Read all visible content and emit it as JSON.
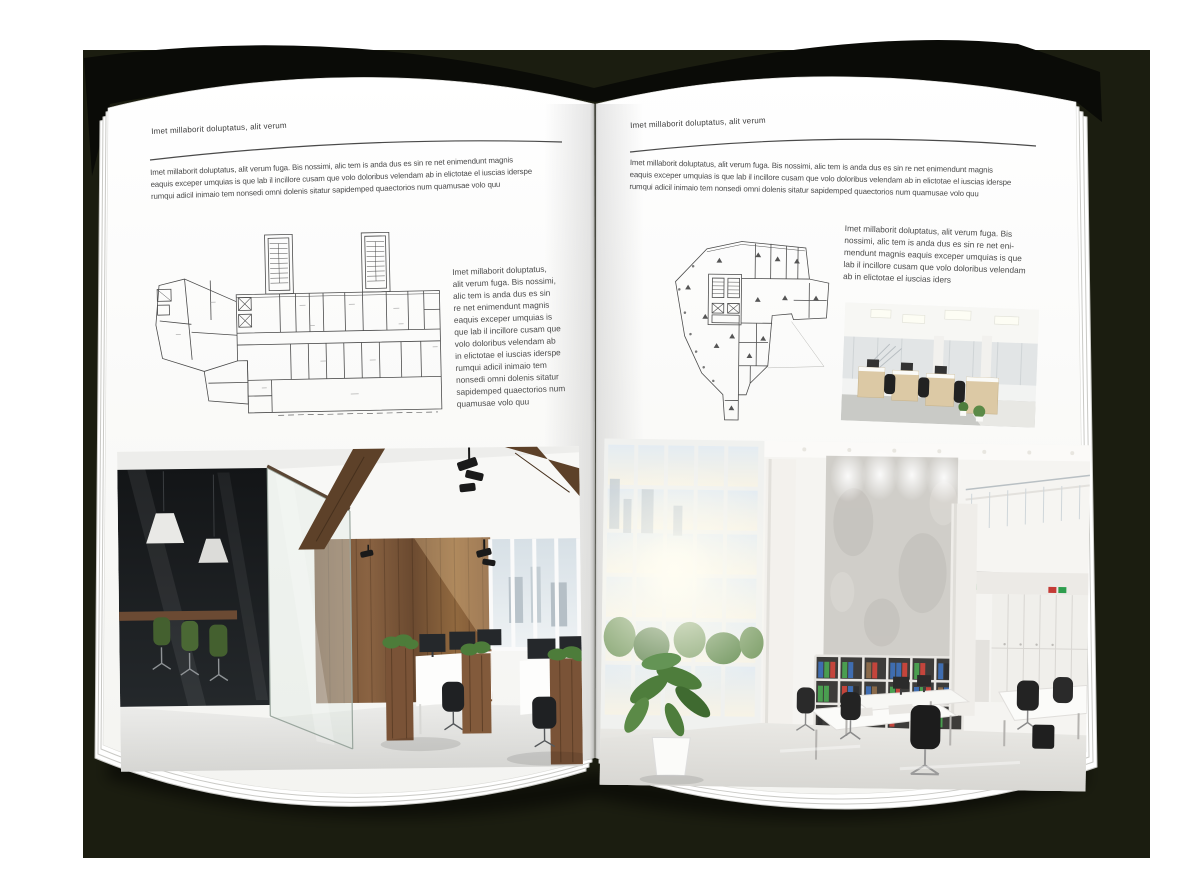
{
  "palette": {
    "backdrop": "#1b1d10",
    "cover": "#0a0b07",
    "page": "#ffffff",
    "text": "#4a4a4a",
    "rule": "#4a4a4a",
    "plan_line": "#4a4a4a",
    "wood": "#7a5639",
    "plant_green": "#4e7d3c"
  },
  "book": {
    "left_page": {
      "header": "Imet millaborit doluptatus, alit verum",
      "intro_lines": [
        "Imet millaborit doluptatus, alit verum fuga. Bis nossimi, alic tem is anda dus es sin re net enimendunt magnis",
        "eaquis exceper umquias is que lab il incillore cusam que volo doloribus velendam ab in elictotae el iuscias iderspe",
        "rumqui adicil inimaio tem nonsedi omni dolenis sitatur sapidemped quaectorios num quamusae volo quu"
      ],
      "side_column_lines": [
        "Imet millaborit doluptatus,",
        "alit verum fuga. Bis nossimi,",
        "alic tem is anda dus es sin",
        "re net enimendunt magnis",
        "eaquis exceper umquias is",
        "que lab il incillore cusam que",
        "volo doloribus velendam ab",
        "in elictotae el iuscias iderspe",
        "rumqui adicil inimaio tem",
        "nonsedi omni dolenis sitatur",
        "sapidemped quaectorios num",
        "quamusae volo quu"
      ]
    },
    "right_page": {
      "header": "Imet millaborit doluptatus, alit verum",
      "intro_lines": [
        "Imet millaborit doluptatus, alit verum fuga. Bis nossimi, alic tem is anda dus es sin re net enimendunt magnis",
        "eaquis exceper umquias is que lab il incillore cusam que volo doloribus velendam ab in elictotae el iuscias iderspe",
        "rumqui adicil inimaio tem nonsedi omni dolenis sitatur sapidemped quaectorios num quamusae volo quu"
      ],
      "side_column_lines": [
        "Imet millaborit doluptatus, alit verum fuga. Bis",
        "nossimi, alic tem is anda dus es sin re net eni-",
        "mendunt magnis eaquis exceper umquias is que",
        "lab il incillore cusam que volo doloribus velendam",
        "ab in elictotae el iuscias iders"
      ]
    }
  }
}
